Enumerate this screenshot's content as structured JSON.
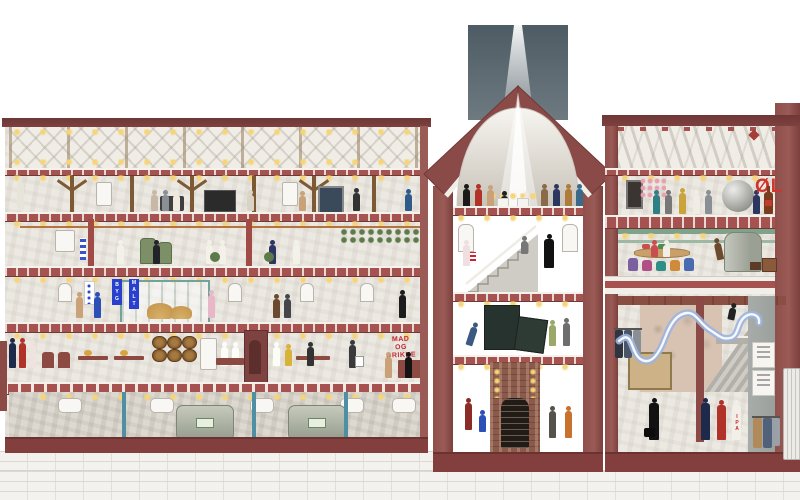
{
  "labels": {
    "mad_og_drikke": {
      "lines": [
        "MAD",
        "OG",
        "DRIKKE"
      ],
      "color": "#c4262e"
    },
    "oel": {
      "text": "ØL",
      "color": "#d0342c"
    },
    "byg": {
      "text": "BYG"
    },
    "malt": {
      "text": "MALT"
    },
    "ipa": {
      "text": "IPA"
    }
  },
  "palette": {
    "wall_maroon": "#9a5a56",
    "wall_maroon_dark": "#7c403d",
    "coping": "#713a3a",
    "stone": "#ece9e2",
    "stone_dark": "#ddd9d0",
    "brick_base": "#f4f2ee",
    "chimney_slate": "#5f6d76",
    "timber_brown": "#7d5a33",
    "teal_pipe": "#4f8fa3",
    "green_beam": "#7fa28a",
    "banner_blue": "#2940cf",
    "slide_blue": "#9db4dd",
    "lamp_yellow": "#f6d478"
  }
}
